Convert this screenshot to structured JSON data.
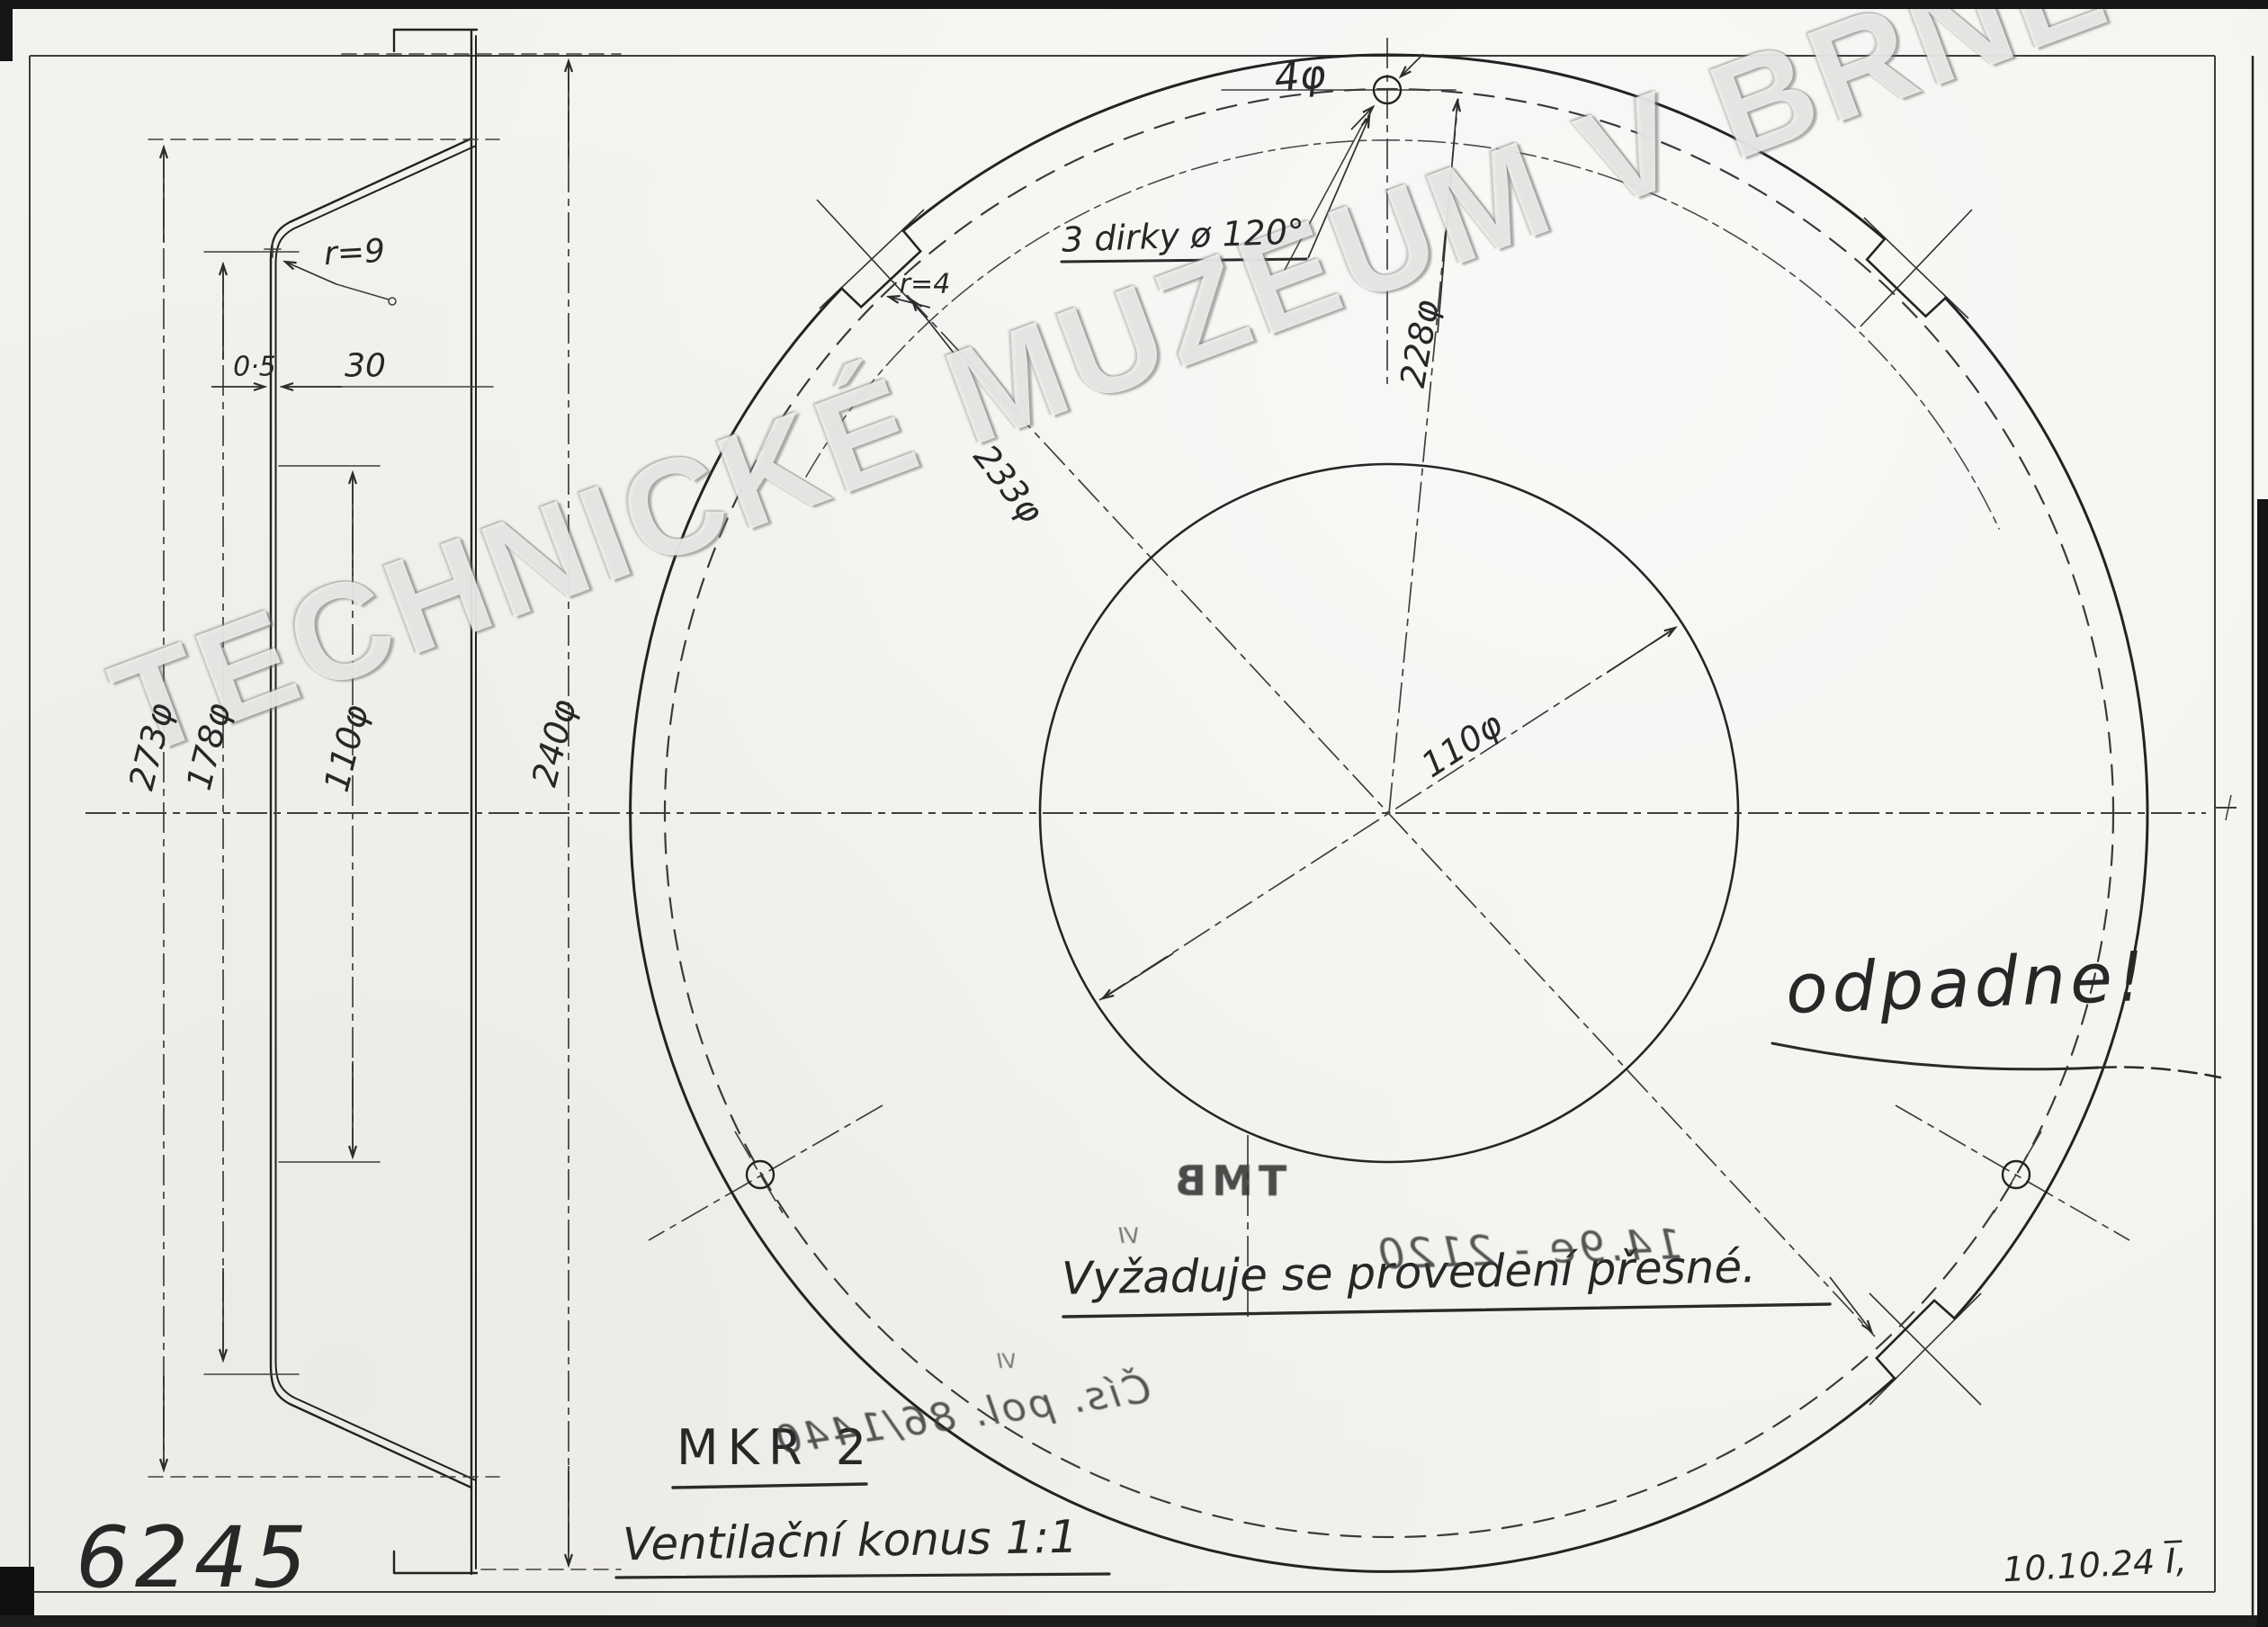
{
  "sheet": {
    "drawing_number": "6245",
    "date": "10.10.24 I̅,",
    "title": "Ventilační konus 1:1",
    "marking": "MKR 2"
  },
  "watermark": "TECHNICKÉ MUZEUM V BRNĚ",
  "side_view": {
    "corner_radius": "r=9",
    "thickness": "0·5",
    "flange_width": "30",
    "dia_outer": "273φ",
    "dia_mid": "178φ",
    "dia_inner": "110φ",
    "dia_overall": "240φ"
  },
  "front_view": {
    "hole_dia": "4φ",
    "holes_note": "3 dirky ø 120°",
    "notch_radius": "r=4",
    "dia_notch_circle": "233φ",
    "dia_bolt_circle": "228φ",
    "dia_center_hole": "110φ"
  },
  "annotations": {
    "odpadne": "odpadne!",
    "requirement": "Vyžaduje se provedení přesné."
  },
  "stamps": {
    "tmb": "TMB",
    "vi": "VI",
    "line1": "14.9e - 2120",
    "line2": "Čís. pol. 86/1440"
  }
}
